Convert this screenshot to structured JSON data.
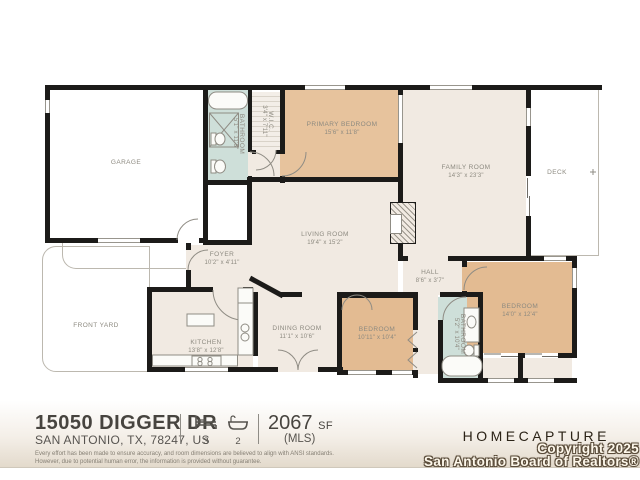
{
  "colors": {
    "wall": "#1c1b19",
    "room_beige": "#f1eae2",
    "room_tan": "#e7c39d",
    "room_teal": "#cedfd9",
    "label": "#8d8a80",
    "footer_bg": "#e3dacc"
  },
  "rooms": {
    "garage": {
      "name": "GARAGE"
    },
    "bathroom_primary": {
      "name": "BATHROOM",
      "dims": "5'1\" x 11'8\""
    },
    "wic": {
      "name": "W.I.C.",
      "dims": "3'4\" x 7'11\""
    },
    "primary_bedroom": {
      "name": "PRIMARY BEDROOM",
      "dims": "15'6\" x 11'8\""
    },
    "family_room": {
      "name": "FAMILY ROOM",
      "dims": "14'3\" x 23'3\""
    },
    "deck": {
      "name": "DECK"
    },
    "living_room": {
      "name": "LIVING ROOM",
      "dims": "19'4\" x 15'2\""
    },
    "foyer": {
      "name": "FOYER",
      "dims": "10'2\" x 4'11\""
    },
    "front_yard": {
      "name": "FRONT YARD"
    },
    "kitchen": {
      "name": "KITCHEN",
      "dims": "13'8\" x 12'8\""
    },
    "dining_room": {
      "name": "DINING ROOM",
      "dims": "11'1\" x 10'6\""
    },
    "hall": {
      "name": "HALL",
      "dims": "8'6\" x 3'7\""
    },
    "bedroom_2": {
      "name": "BEDROOM",
      "dims": "10'11\" x 10'4\""
    },
    "bathroom_hall": {
      "name": "BATHROOM",
      "dims": "5'2\" x 10'4\""
    },
    "bedroom_3": {
      "name": "BEDROOM",
      "dims": "14'0\" x 12'4\""
    }
  },
  "footer": {
    "address_line1": "15050 DIGGER DR",
    "address_line2": "SAN ANTONIO, TX, 78247, US",
    "beds": "3",
    "baths": "2",
    "area_value": "2067",
    "area_unit": "SF",
    "area_source": "(MLS)",
    "brand": "HOMECAPTURE",
    "watermark_line1": "Copyright 2025",
    "watermark_line2": "San Antonio Board of Realtors®",
    "disclaimer_line1": "Every effort has been made to ensure accuracy, and room dimensions are believed to align with ANSI standards.",
    "disclaimer_line2": "However, due to potential human error, the information is provided without guarantee."
  },
  "icons": {
    "beds": "bed-icon",
    "baths": "bathtub-icon"
  }
}
